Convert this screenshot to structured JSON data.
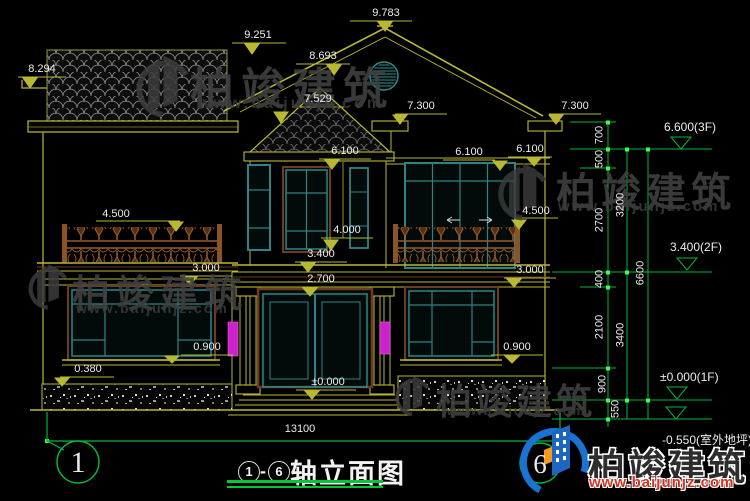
{
  "dims": {
    "d9783": "9.783",
    "d9251": "9.251",
    "d8693": "8.693",
    "d8294": "8.294",
    "d7529": "7.529",
    "d7300_left": "7.300",
    "d7300_right": "7.300",
    "d6100_center": "6.100",
    "d6100_right": "6.100",
    "d6100_far_right": "6.100",
    "d4500_left": "4.500",
    "d4500_right": "4.500",
    "d4000": "4.000",
    "d3400": "3.400",
    "d3000_left": "3.000",
    "d3000_right": "3.000",
    "d2700": "2.700",
    "d0900_left": "0.900",
    "d0900_right": "0.900",
    "d0380": "0.380",
    "d0000": "±0.000",
    "total_width": "13100"
  },
  "chain": {
    "c700": "700",
    "c500": "500",
    "c2700": "2700",
    "c400": "400",
    "c2100": "2100",
    "c900": "900",
    "c550": "550",
    "c3200": "3200",
    "c3400": "3400",
    "c6600": "6600"
  },
  "levels": {
    "f3": "6.600(3F)",
    "f2": "3.400(2F)",
    "f1": "±0.000(1F)",
    "outdoor": "-0.550(室外地坪)"
  },
  "axes": {
    "left_bubble": "1",
    "right_bubble": "6"
  },
  "title": {
    "bubble_start": "1",
    "dash": "-",
    "bubble_end": "6",
    "text": "轴立面图"
  },
  "watermark": {
    "brand": "柏竣建筑",
    "site": "www.baijunjz.com"
  },
  "logo": {
    "brand": "柏竣建筑",
    "site": "www.baijunjz.com"
  }
}
